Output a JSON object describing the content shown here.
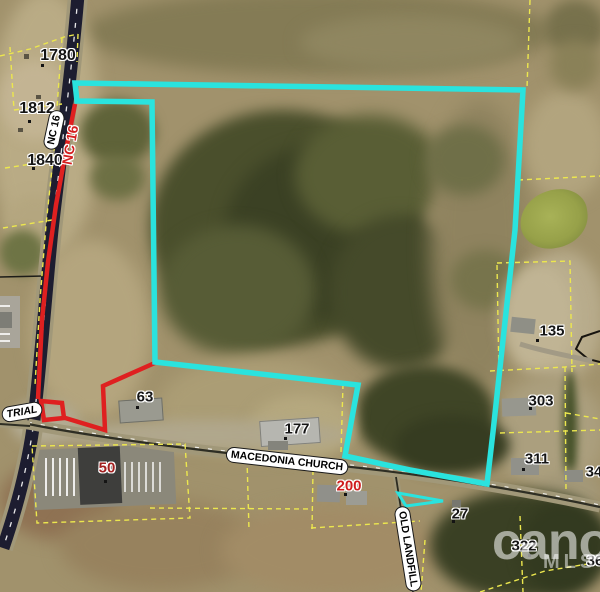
{
  "colors": {
    "subject_boundary": "#2ae3de",
    "outparcel_boundary": "#df2020",
    "parcel_line": "#ece74e",
    "road_dark": "#1d1d30",
    "road_gray": "#a19879"
  },
  "parcel_numbers": {
    "p1780": "1780",
    "p1812": "1812",
    "p1840": "1840",
    "p63": "63",
    "p177": "177",
    "p200": "200",
    "p50": "50",
    "p135": "135",
    "p303": "303",
    "p311": "311",
    "p34": "34",
    "p27": "27",
    "p322": "322",
    "p36": "36"
  },
  "road_labels": {
    "nc16": "NC 16",
    "nc16_red": "NC 16",
    "macedonia_church": "MACEDONIA CHURCH",
    "old_landfill": "OLD LANDFILL",
    "industrial_partial": "TRIAL"
  },
  "watermark": {
    "brand": "cano",
    "mls": "MLS"
  }
}
